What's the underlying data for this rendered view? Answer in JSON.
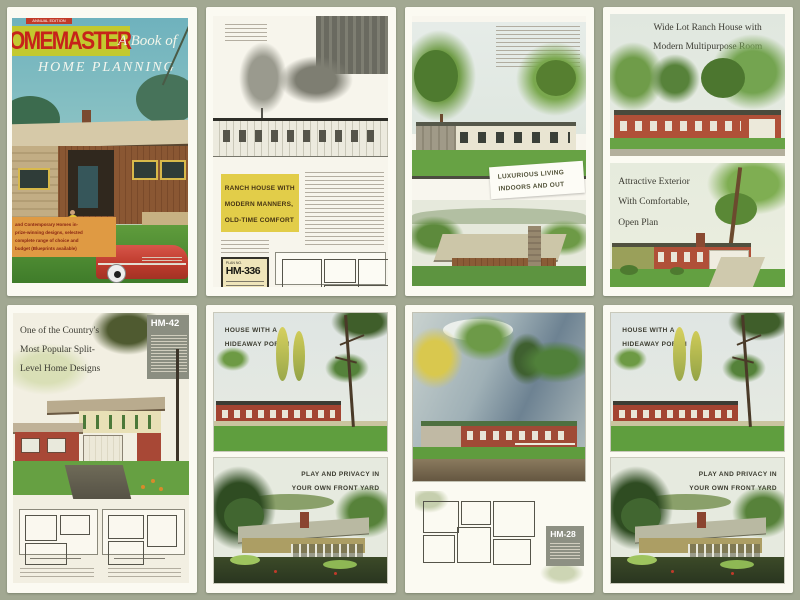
{
  "colors": {
    "background": "#a2a892",
    "card": "#fbfaf2",
    "masthead_band_yellow": "#c3c92f",
    "masthead_red": "#c6231a",
    "cover_sky_blue": "#6fb2bd",
    "blurb_orange": "#df9a43",
    "heading_block_yellow": "#e2cd49",
    "brick_red": "#a84836",
    "lawn_green": "#5f9c3e",
    "plan_box_gray": "#8b8e81"
  },
  "panels": [
    {
      "name": "book-cover",
      "edition_tag": "ANNUAL EDITION",
      "masthead": "OMEMASTER",
      "subtitle_line1": "A Book of",
      "subtitle_line2": "HOME PLANNING",
      "price": "50¢",
      "blurb_lines": [
        "and Contemporary Homes in-",
        "prize-winning designs, selected",
        "complete range of choice and",
        "budget (Blueprints available)"
      ]
    },
    {
      "name": "ranch-house-article",
      "headline_lines": [
        "RANCH HOUSE WITH",
        "MODERN MANNERS,",
        "OLD-TIME COMFORT"
      ],
      "plan_label": "PLAN NO.",
      "plan_no": "HM-336"
    },
    {
      "name": "luxurious-living-page",
      "headline_lines": [
        "LUXURIOUS LIVING",
        "INDOORS AND OUT"
      ]
    },
    {
      "name": "wide-lot-ranch-page",
      "headline_top_lines": [
        "Wide Lot Ranch House with",
        "Modern Multipurpose Room"
      ],
      "headline_bottom_lines": [
        "Attractive Exterior",
        "With Comfortable,",
        "Open Plan"
      ]
    },
    {
      "name": "split-level-page",
      "headline_lines": [
        "One of the Country's",
        "Most Popular Split-",
        "Level Home Designs"
      ],
      "plan_no": "HM-42"
    },
    {
      "name": "hideaway-porch-page",
      "headline_top_lines": [
        "HOUSE WITH A",
        "HIDEAWAY PORCH"
      ],
      "headline_bottom_lines": [
        "PLAY AND PRIVACY IN",
        "YOUR OWN FRONT YARD"
      ]
    },
    {
      "name": "floor-plan-page",
      "plan_no": "HM-28"
    },
    {
      "name": "hideaway-porch-page-duplicate",
      "headline_top_lines": [
        "HOUSE WITH A",
        "HIDEAWAY PORCH"
      ],
      "headline_bottom_lines": [
        "PLAY AND PRIVACY IN",
        "YOUR OWN FRONT YARD"
      ]
    }
  ]
}
